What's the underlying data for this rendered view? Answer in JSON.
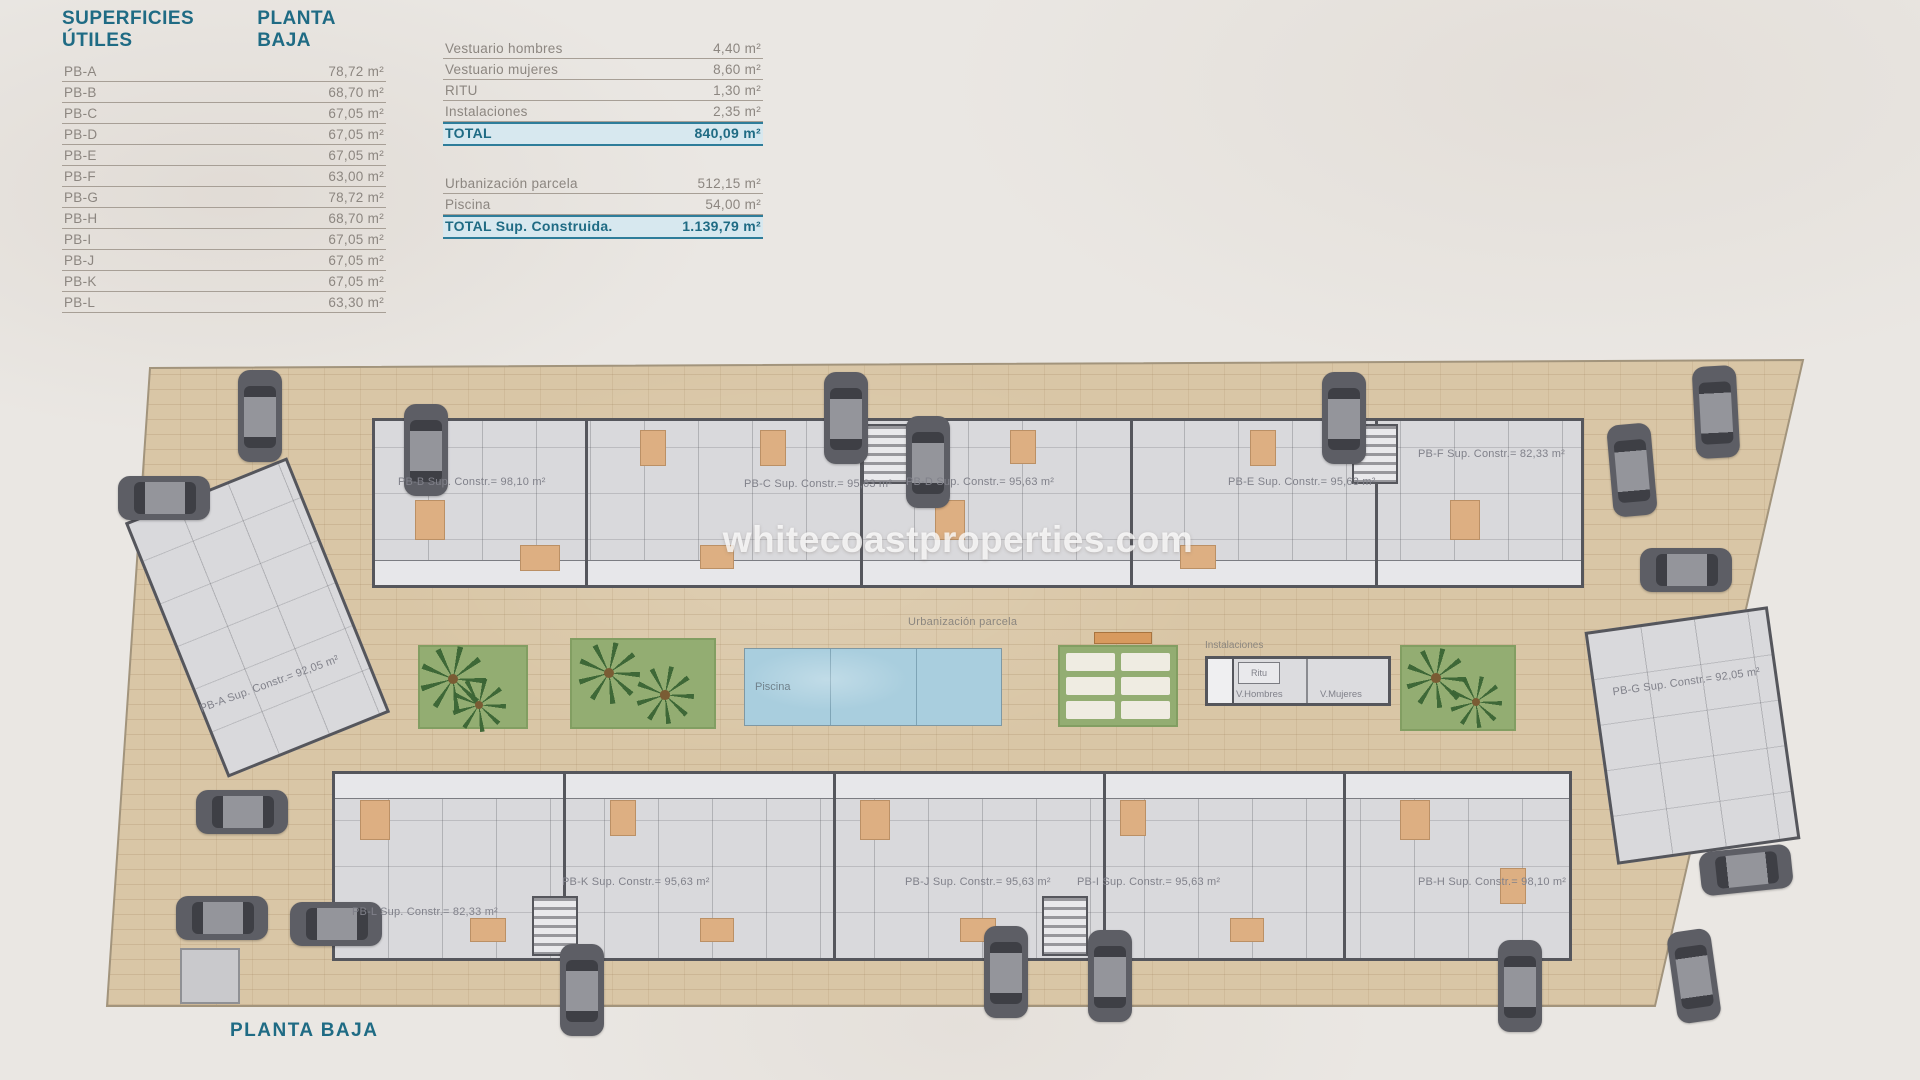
{
  "page": {
    "title_left": "SUPERFICIES ÚTILES",
    "title_right": "PLANTA BAJA",
    "footer_title": "PLANTA BAJA",
    "watermark": "whitecoastproperties.com"
  },
  "colors": {
    "accent_teal": "#1f6b84",
    "highlight_blue": "#d7e8ef",
    "paving_tan": "#d9c6a6",
    "garden_green": "#93ad72",
    "pool_blue": "#a9cede"
  },
  "surfaces_table": {
    "rows": [
      {
        "name": "PB-A",
        "value": "78,72 m²"
      },
      {
        "name": "PB-B",
        "value": "68,70 m²"
      },
      {
        "name": "PB-C",
        "value": "67,05 m²"
      },
      {
        "name": "PB-D",
        "value": "67,05 m²"
      },
      {
        "name": "PB-E",
        "value": "67,05 m²"
      },
      {
        "name": "PB-F",
        "value": "63,00 m²"
      },
      {
        "name": "PB-G",
        "value": "78,72 m²"
      },
      {
        "name": "PB-H",
        "value": "68,70 m²"
      },
      {
        "name": "PB-I",
        "value": "67,05 m²"
      },
      {
        "name": "PB-J",
        "value": "67,05 m²"
      },
      {
        "name": "PB-K",
        "value": "67,05 m²"
      },
      {
        "name": "PB-L",
        "value": "63,30 m²"
      }
    ]
  },
  "totals_table": {
    "group1": [
      {
        "name": "Vestuario hombres",
        "value": "4,40 m²"
      },
      {
        "name": "Vestuario mujeres",
        "value": "8,60 m²"
      },
      {
        "name": "RITU",
        "value": "1,30 m²"
      },
      {
        "name": "Instalaciones",
        "value": "2,35 m²"
      }
    ],
    "total1": {
      "name": "TOTAL",
      "value": "840,09 m²"
    },
    "group2": [
      {
        "name": "Urbanización parcela",
        "value": "512,15 m²"
      },
      {
        "name": "Piscina",
        "value": "54,00 m²"
      }
    ],
    "total2": {
      "name": "TOTAL Sup. Construida.",
      "value": "1.139,79 m²"
    }
  },
  "plan": {
    "units": [
      {
        "id": "PB-A",
        "label": "PB-A Sup. Constr.= 92,05 m²"
      },
      {
        "id": "PB-B",
        "label": "PB-B Sup. Constr.= 98,10 m²"
      },
      {
        "id": "PB-C",
        "label": "PB-C Sup. Constr.= 95,63 m²"
      },
      {
        "id": "PB-D",
        "label": "PB-D Sup. Constr.= 95,63 m²"
      },
      {
        "id": "PB-E",
        "label": "PB-E Sup. Constr.= 95,63 m²"
      },
      {
        "id": "PB-F",
        "label": "PB-F Sup. Constr.= 82,33 m²"
      },
      {
        "id": "PB-G",
        "label": "PB-G Sup. Constr.= 92,05 m²"
      },
      {
        "id": "PB-H",
        "label": "PB-H Sup. Constr.= 98,10 m²"
      },
      {
        "id": "PB-I",
        "label": "PB-I Sup. Constr.= 95,63 m²"
      },
      {
        "id": "PB-J",
        "label": "PB-J Sup. Constr.= 95,63 m²"
      },
      {
        "id": "PB-K",
        "label": "PB-K Sup. Constr.= 95,63 m²"
      },
      {
        "id": "PB-L",
        "label": "PB-L Sup. Constr.= 82,33 m²"
      }
    ],
    "labels": {
      "urbanizacion": "Urbanización parcela",
      "piscina": "Piscina",
      "instalaciones": "Instalaciones",
      "ritu": "Ritu",
      "v_hombres": "V.Hombres",
      "v_mujeres": "V.Mujeres"
    }
  }
}
